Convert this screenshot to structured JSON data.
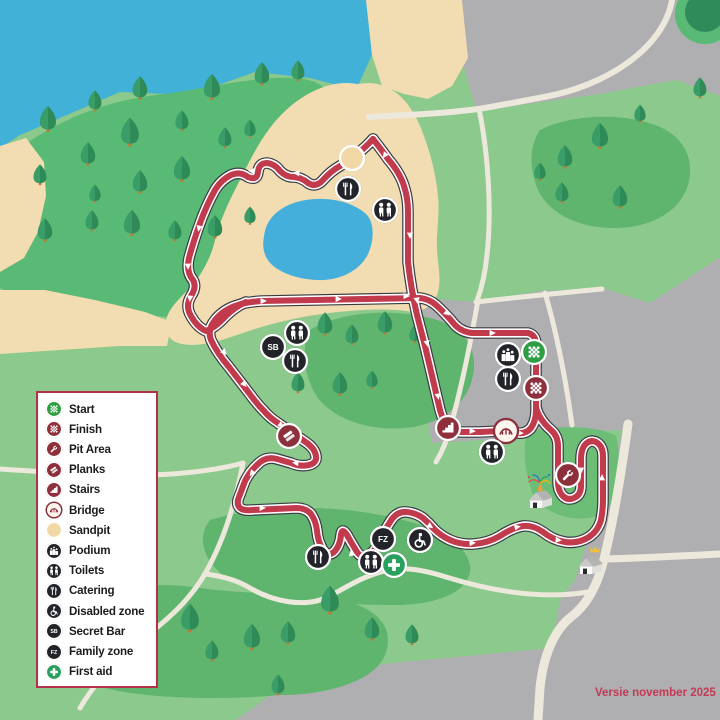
{
  "legend": {
    "items": [
      {
        "id": "start",
        "label": "Start"
      },
      {
        "id": "finish",
        "label": "Finish"
      },
      {
        "id": "pit-area",
        "label": "Pit Area"
      },
      {
        "id": "planks",
        "label": "Planks"
      },
      {
        "id": "stairs",
        "label": "Stairs"
      },
      {
        "id": "bridge",
        "label": "Bridge"
      },
      {
        "id": "sandpit",
        "label": "Sandpit"
      },
      {
        "id": "podium",
        "label": "Podium"
      },
      {
        "id": "toilets",
        "label": "Toilets"
      },
      {
        "id": "catering",
        "label": "Catering"
      },
      {
        "id": "disabled-zone",
        "label": "Disabled zone"
      },
      {
        "id": "secret-bar",
        "label": "Secret Bar"
      },
      {
        "id": "family-zone",
        "label": "Family zone"
      },
      {
        "id": "first-aid",
        "label": "First aid"
      }
    ]
  },
  "map": {
    "markers": [
      {
        "type": "sandpit",
        "x": 352,
        "y": 158
      },
      {
        "type": "catering",
        "x": 348,
        "y": 189
      },
      {
        "type": "toilets",
        "x": 385,
        "y": 210
      },
      {
        "type": "toilets",
        "x": 297,
        "y": 333
      },
      {
        "type": "secret-bar",
        "x": 273,
        "y": 347
      },
      {
        "type": "catering",
        "x": 295,
        "y": 361
      },
      {
        "type": "planks",
        "x": 289,
        "y": 436
      },
      {
        "type": "stairs",
        "x": 448,
        "y": 428
      },
      {
        "type": "bridge",
        "x": 506,
        "y": 431
      },
      {
        "type": "toilets",
        "x": 492,
        "y": 452
      },
      {
        "type": "podium",
        "x": 508,
        "y": 355
      },
      {
        "type": "catering",
        "x": 508,
        "y": 379
      },
      {
        "type": "start",
        "x": 534,
        "y": 352
      },
      {
        "type": "finish",
        "x": 536,
        "y": 388
      },
      {
        "type": "pit-area",
        "x": 568,
        "y": 475
      },
      {
        "type": "catering",
        "x": 318,
        "y": 557
      },
      {
        "type": "family-zone",
        "x": 383,
        "y": 539
      },
      {
        "type": "disabled-zone",
        "x": 420,
        "y": 540
      },
      {
        "type": "toilets",
        "x": 371,
        "y": 562
      },
      {
        "type": "first-aid",
        "x": 394,
        "y": 565
      }
    ],
    "houses": [
      {
        "type": "party-house",
        "x": 540,
        "y": 497
      },
      {
        "type": "crown-house",
        "x": 590,
        "y": 563
      }
    ],
    "secret_bar_text": "SB",
    "family_zone_text": "FZ"
  },
  "version_label": "Versie november 2025",
  "colors": {
    "course_red": "#C23B4D",
    "course_outline": "#3A3B42",
    "dark_red": "#8E2F3C",
    "icon_black": "#22242A",
    "start_green": "#2E9E43",
    "first_aid_green": "#2AA05E",
    "sand": "#F2DCB2",
    "water": "#41B1D8",
    "grass": "#8CC98C",
    "grass_dark": "#5FB46E",
    "peninsula_green": "#58BA74",
    "tree_green": "#2E8A56",
    "gray": "#AFAFB1",
    "road": "#EDE8DC",
    "legend_border": "#B23148",
    "version_color": "#C23A55"
  }
}
